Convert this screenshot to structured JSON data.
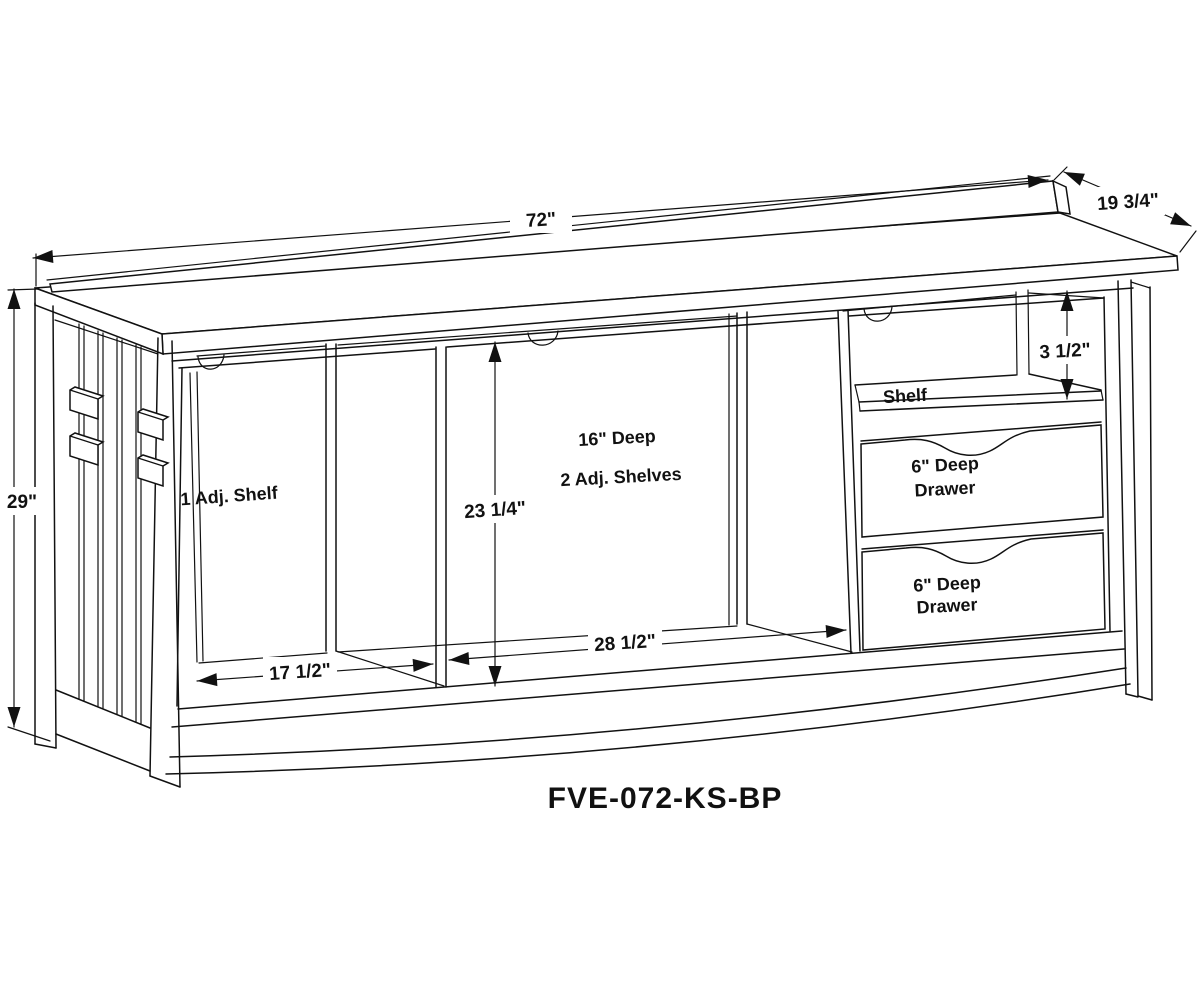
{
  "drawing": {
    "model_number": "FVE-072-KS-BP",
    "line_color": "#111111",
    "background_color": "#ffffff",
    "dimensions": {
      "overall_width": "72\"",
      "overall_depth": "19 3/4\"",
      "overall_height": "29\"",
      "top_right_opening_height": "3 1/2\"",
      "middle_opening_height": "23 1/4\"",
      "left_opening_width": "17 1/2\"",
      "middle_opening_width": "28 1/2\""
    },
    "sections": {
      "left": {
        "label": "1 Adj. Shelf"
      },
      "middle": {
        "label_line1": "16\" Deep",
        "label_line2": "2 Adj. Shelves"
      },
      "right": {
        "shelf_label": "Shelf",
        "drawer1_label_line1": "6\" Deep",
        "drawer1_label_line2": "Drawer",
        "drawer2_label_line1": "6\" Deep",
        "drawer2_label_line2": "Drawer"
      }
    }
  }
}
